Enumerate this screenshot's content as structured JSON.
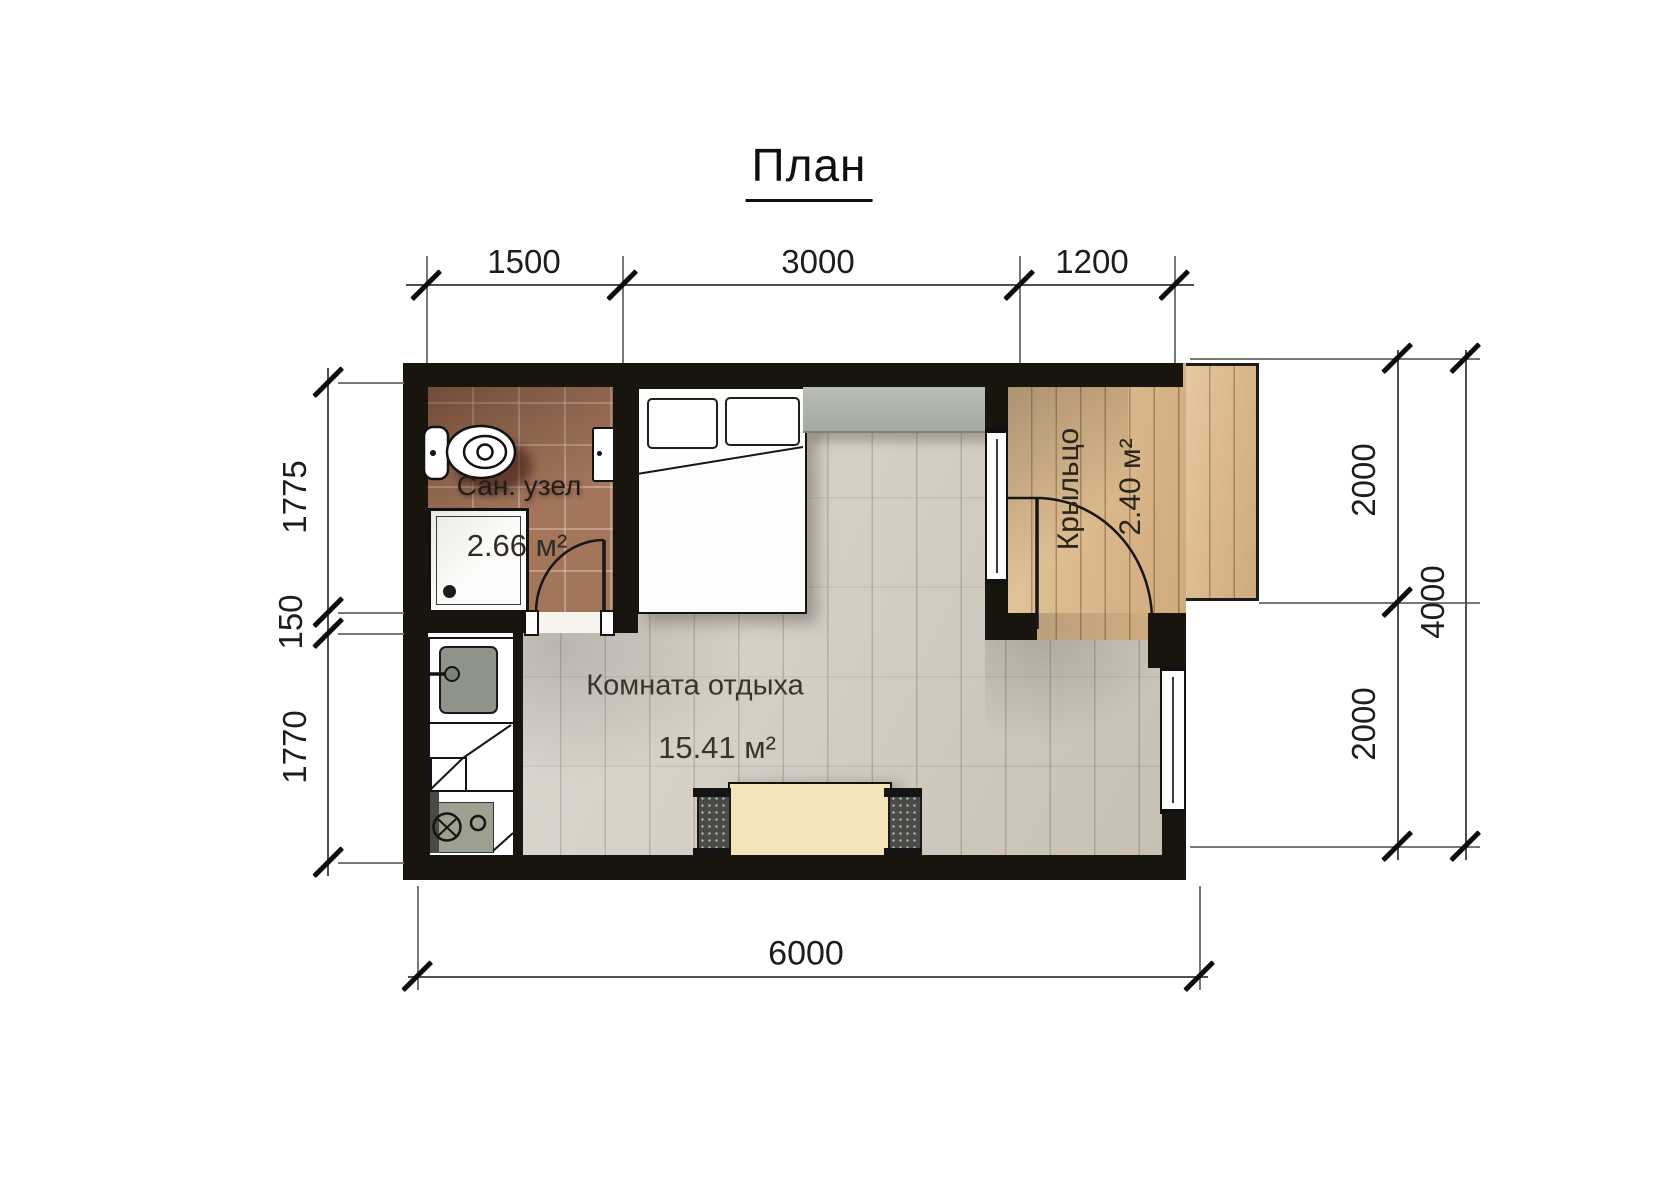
{
  "title": "План",
  "dimensions": {
    "top": [
      "1500",
      "3000",
      "1200"
    ],
    "left": [
      "1775",
      "150",
      "1770"
    ],
    "right": [
      "2000",
      "2000"
    ],
    "right_total": "4000",
    "bottom": "6000"
  },
  "rooms": {
    "bathroom": {
      "name": "Сан. узел",
      "area": "2.66 м²"
    },
    "lounge": {
      "name": "Комната отдыха",
      "area": "15.41 м²"
    },
    "porch": {
      "name": "Крыльцо",
      "area": "2.40 м²"
    }
  },
  "furniture_icons": [
    "toilet-icon",
    "shower-tray-icon",
    "wall-cabinet-icon",
    "kitchen-sink-icon",
    "kitchen-counter-icon",
    "stove-icon",
    "double-bed-icon",
    "pillow-icon",
    "dresser-icon",
    "dining-table-icon",
    "bench-icon",
    "door-swing-icon",
    "window-icon"
  ],
  "colors": {
    "wall": "#18140e",
    "bathroom_floor": "#a3765c",
    "deck_floor": "#deba8c",
    "room_floor": "#d8d2c8",
    "kitchen_floor": "#fdfdfb",
    "table": "#f3e5b9",
    "dresser": "#afb4ab",
    "dimension_text": "#1d1d1d"
  }
}
